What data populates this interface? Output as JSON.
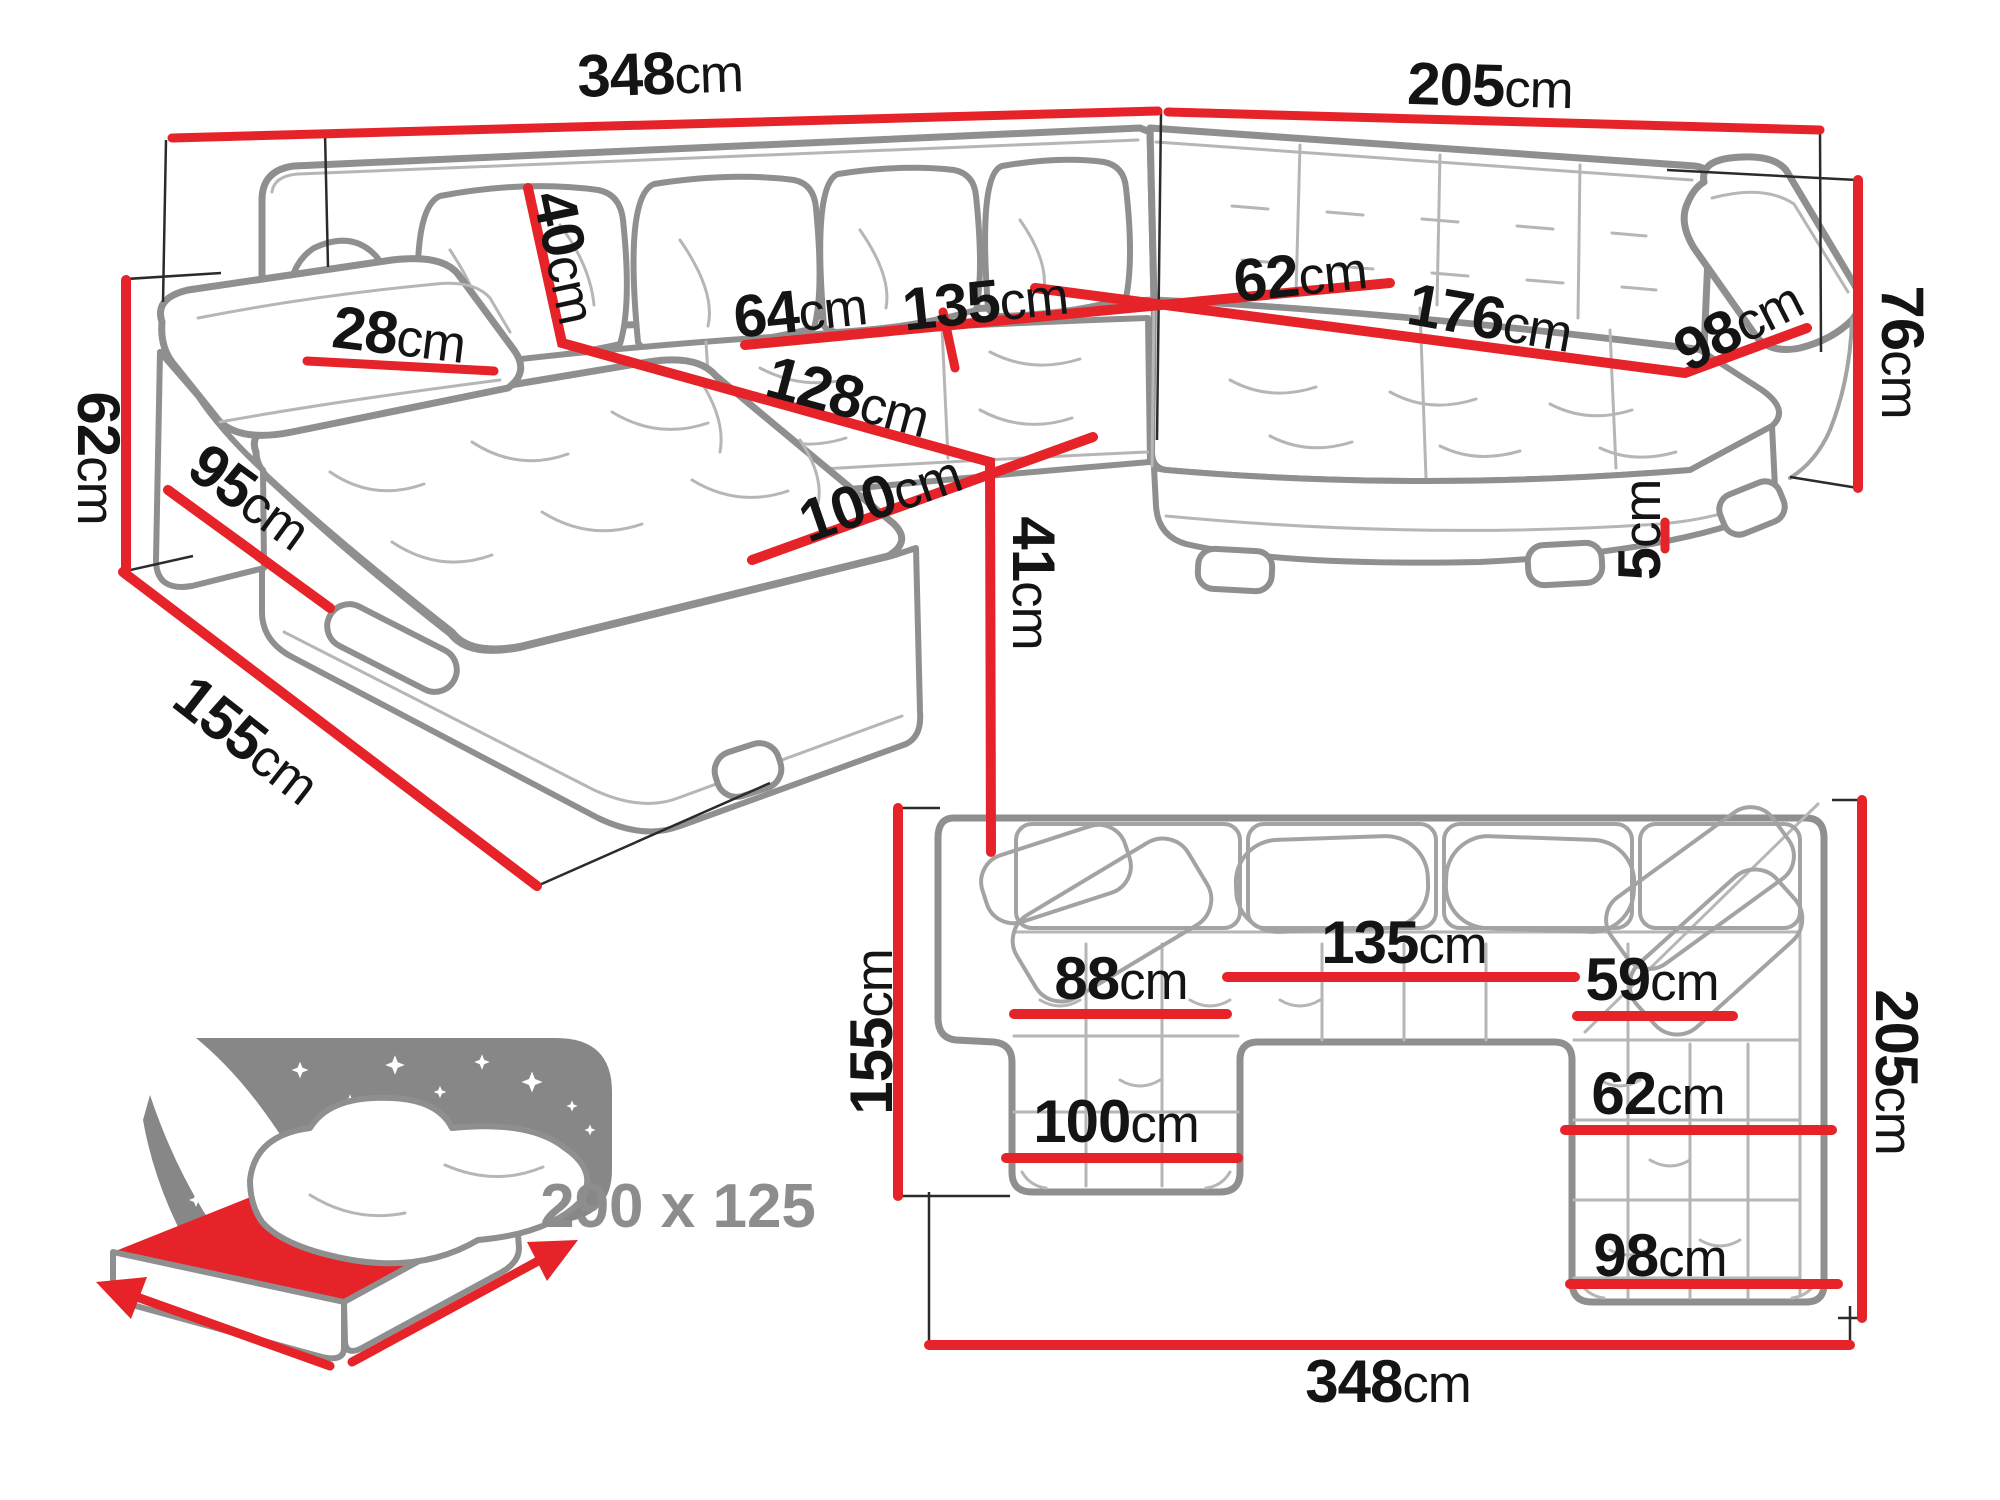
{
  "colors": {
    "dimension_red": "#e52328",
    "art_gray": "#8f8f8f",
    "detail_gray": "#b6b6b6",
    "text_black": "#141414",
    "icon_gray": "#878787",
    "sleeping_label_gray": "#8d8d8d"
  },
  "icons": {
    "sleeping_function": "bed-with-starry-headboard-icon"
  },
  "p3d": {
    "w348": {
      "num": "348",
      "unit": "cm"
    },
    "d205": {
      "num": "205",
      "unit": "cm"
    },
    "h76": {
      "num": "76",
      "unit": "cm"
    },
    "h62": {
      "num": "62",
      "unit": "cm"
    },
    "arm28": {
      "num": "28",
      "unit": "cm"
    },
    "pillow40": {
      "num": "40",
      "unit": "cm"
    },
    "seat64": {
      "num": "64",
      "unit": "cm"
    },
    "seat135": {
      "num": "135",
      "unit": "cm"
    },
    "seat62": {
      "num": "62",
      "unit": "cm"
    },
    "seat128": {
      "num": "128",
      "unit": "cm"
    },
    "seat176": {
      "num": "176",
      "unit": "cm"
    },
    "seat98": {
      "num": "98",
      "unit": "cm"
    },
    "seat100": {
      "num": "100",
      "unit": "cm"
    },
    "h41": {
      "num": "41",
      "unit": "cm"
    },
    "side95": {
      "num": "95",
      "unit": "cm"
    },
    "side155": {
      "num": "155",
      "unit": "cm"
    },
    "leg5": {
      "num": "5",
      "unit": "cm"
    }
  },
  "plan": {
    "d155": {
      "num": "155",
      "unit": "cm"
    },
    "w88": {
      "num": "88",
      "unit": "cm"
    },
    "w135": {
      "num": "135",
      "unit": "cm"
    },
    "w100": {
      "num": "100",
      "unit": "cm"
    },
    "w59": {
      "num": "59",
      "unit": "cm"
    },
    "w62": {
      "num": "62",
      "unit": "cm"
    },
    "w98": {
      "num": "98",
      "unit": "cm"
    },
    "d205": {
      "num": "205",
      "unit": "cm"
    },
    "w348": {
      "num": "348",
      "unit": "cm"
    }
  },
  "sleeping_area": {
    "label": "290 x 125"
  }
}
